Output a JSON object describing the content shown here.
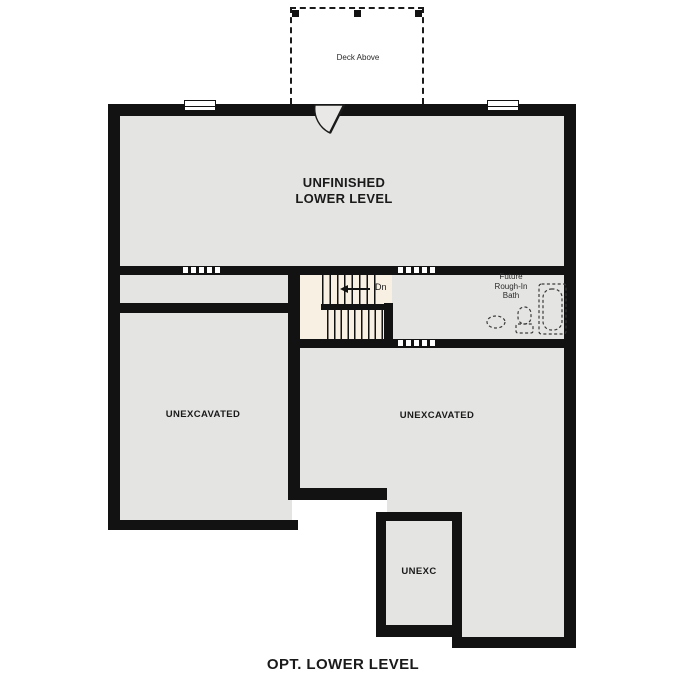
{
  "plan": {
    "title": "OPT. LOWER LEVEL",
    "deck": {
      "label": "Deck Above"
    },
    "rooms": {
      "main": "UNFINISHED\nLOWER LEVEL",
      "left_unexcavated": "UNEXCAVATED",
      "right_unexcavated": "UNEXCAVATED",
      "small_unexcavated": "UNEXC",
      "bath": "Future\nRough-In\nBath"
    },
    "stairs": {
      "direction_label": "Dn"
    },
    "colors": {
      "wall": "#121212",
      "floor_gray": "#e4e4e3",
      "stairs_cream": "#f8f0e2",
      "door_fill": "#e9e8e6",
      "fixture_outline": "#3a3a3a",
      "background": "#ffffff"
    }
  }
}
